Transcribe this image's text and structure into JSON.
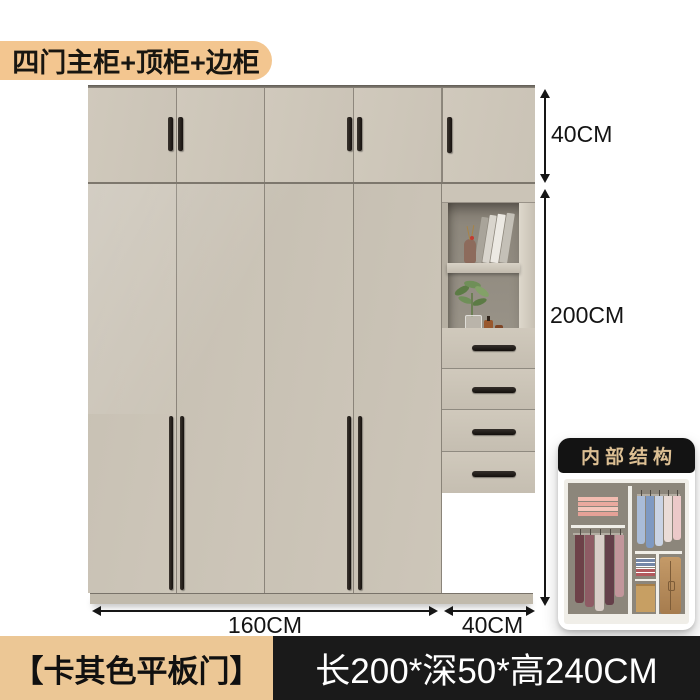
{
  "badge": {
    "label": "四门主柜+顶柜+边柜"
  },
  "dimensions": {
    "top_cabinet_height": "40CM",
    "body_height": "200CM",
    "main_width": "160CM",
    "side_width": "40CM"
  },
  "inset": {
    "title": "内部结构"
  },
  "footer": {
    "color_label": "【卡其色平板门】",
    "size_label": "长200*深50*高240CM"
  },
  "colors": {
    "badge_bg": "#f3c690",
    "cabinet_body": "#cbc4b7",
    "cabinet_edge": "#6b655c",
    "handle": "#211c18",
    "niche_back": "#948e83",
    "dimension_text": "#141414",
    "footer_left_bg": "#ecc795",
    "footer_right_bg": "#1a1a1a",
    "inset_title_color": "#dcbf93"
  }
}
